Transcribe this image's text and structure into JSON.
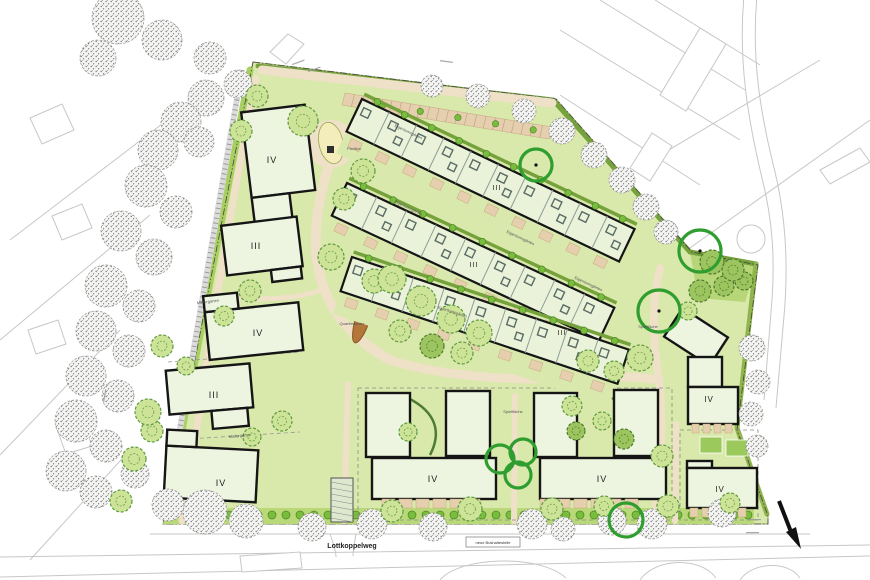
{
  "plan": {
    "street_name": "Lottkoppelweg",
    "bus_stop_label": "neue Bushaltestelle",
    "square_label": "Quartiersplatz",
    "pavilion_label": "Pavillon",
    "play_label": "Spielfläche",
    "owner_garden_label": "Eigentumsgärten",
    "tenant_garden_label": "Mietergärten"
  },
  "colors": {
    "lawn": "#d9e8ab",
    "lawn2": "#cfe39c",
    "rowfill": "#eaf3da",
    "bldg": "#edf5e1",
    "tan": "#efe0c8",
    "tandark": "#e5cfae",
    "hedge": "#76a23c",
    "hedge2": "#a9cf63",
    "bush": "#79bd3c",
    "bushline": "#4c8428",
    "tree": "#cde397",
    "treeline": "#5d9a3d",
    "dtree": "#9cc45f",
    "dtreeline": "#4d7a2e",
    "yellow": "#f3edbb",
    "ring": "#2f9e2f",
    "ctx": "#c7c7c7",
    "stip": "#777777",
    "black": "#151515",
    "court": "#9bc95c",
    "leaf": "#b5763a",
    "leafline": "#8a5526"
  },
  "site_outline": "253,62 556,99 692,252 758,265 737,430 768,516 768,524 163,524",
  "hedges": [
    {
      "d": "M 258,66 L 553,100",
      "w": 5,
      "c": "#76a23c"
    },
    {
      "d": "M 553,100 L 690,252 L 756,264",
      "w": 5,
      "c": "#76a23c"
    },
    {
      "d": "M 756,264 L 737,428 L 767,514",
      "w": 5,
      "c": "#8fb54c"
    },
    {
      "d": "M 250,70 L 166,515",
      "w": 7,
      "c": "#a9cf63"
    }
  ],
  "ne_wedge": "690,252 757,265 745,302 698,298",
  "bottom_band": {
    "x1": 168,
    "x2": 754,
    "ytop": 508,
    "ybot": 524,
    "bushy": 515,
    "step": 14
  },
  "roads": [
    {
      "d": "M 262,70 L 552,103",
      "w": 9
    },
    {
      "d": "M 331,160 C 315,205 311,248 322,283 C 333,317 359,344 392,361",
      "w": 10
    },
    {
      "d": "M 392,361 C 448,377 517,381 560,378 C 608,375 640,377 659,380",
      "w": 9
    },
    {
      "d": "M 659,380 C 652,338 652,300 660,268",
      "w": 8
    },
    {
      "d": "M 659,380 C 664,428 661,470 656,506",
      "w": 8
    },
    {
      "d": "M 348,384 L 344,521",
      "w": 6
    },
    {
      "d": "M 515,396 L 514,521",
      "w": 6
    },
    {
      "d": "M 676,424 L 675,521",
      "w": 6
    },
    {
      "d": "M 256,78 C 236,180 216,300 201,400 C 193,455 186,492 182,521",
      "w": 7
    },
    {
      "d": "M 232,297 C 260,300 290,300 318,291",
      "w": 5
    }
  ],
  "ladder_path": {
    "d": "M 242,70 L 165,515"
  },
  "parking": {
    "poly": "345,93 552,127 549,139 342,105",
    "n": 22
  },
  "plaza": {
    "cx": 331,
    "cy": 144,
    "r": 24,
    "ell": [
      331,
      143,
      12,
      21,
      -12
    ],
    "pav": [
      327,
      146,
      7,
      7
    ]
  },
  "ovals": [
    {
      "e": [
        412,
        317,
        30,
        18,
        20
      ],
      "f": "#f3edbb"
    },
    {
      "e": [
        444,
        336,
        22,
        12,
        15
      ],
      "f": "#f3edbb"
    },
    {
      "e": [
        268,
        330,
        26,
        13,
        -18
      ],
      "f": "#f0ecc0"
    },
    {
      "e": [
        268,
        330,
        30,
        16,
        -18
      ],
      "f": "none",
      "s": "#6f9c3c"
    },
    {
      "e": [
        402,
        428,
        12,
        9,
        0
      ],
      "f": "#f2ebb7"
    }
  ],
  "swing_circle": [
    416,
    315,
    9
  ],
  "leaf": [
    363,
    318,
    7,
    26,
    18
  ],
  "rows": [
    {
      "x": 362,
      "y": 99,
      "rot": 25.5,
      "len": 302,
      "units": 10
    },
    {
      "x": 347,
      "y": 183,
      "rot": 25,
      "len": 295,
      "units": 9
    },
    {
      "x": 352,
      "y": 257,
      "rot": 18.5,
      "len": 292,
      "units": 9
    }
  ],
  "buildings": [
    {
      "cx": 281,
      "cy": 166,
      "rot": -7,
      "parts": [
        [
          -33,
          -58,
          64,
          86
        ],
        [
          -33,
          28,
          38,
          34
        ]
      ]
    },
    {
      "cx": 262,
      "cy": 247,
      "rot": -7,
      "parts": [
        [
          -38,
          -26,
          76,
          50
        ],
        [
          6,
          24,
          30,
          12
        ]
      ]
    },
    {
      "cx": 255,
      "cy": 331,
      "rot": -6,
      "parts": [
        [
          -48,
          -24,
          94,
          48
        ],
        [
          -48,
          -40,
          34,
          16
        ]
      ]
    },
    {
      "cx": 210,
      "cy": 395,
      "rot": -5,
      "parts": [
        [
          -42,
          -28,
          84,
          44
        ],
        [
          0,
          16,
          36,
          18
        ]
      ]
    },
    {
      "cx": 212,
      "cy": 474,
      "rot": 3,
      "parts": [
        [
          -47,
          -26,
          92,
          52
        ],
        [
          -47,
          -42,
          30,
          16
        ]
      ]
    },
    {
      "cx": 388,
      "cy": 425,
      "rot": 0,
      "parts": [
        [
          -22,
          -32,
          44,
          64
        ]
      ]
    },
    {
      "cx": 468,
      "cy": 423,
      "rot": 0,
      "parts": [
        [
          -22,
          -32,
          44,
          65
        ]
      ]
    },
    {
      "cx": 434,
      "cy": 478,
      "rot": 0,
      "parts": [
        [
          -62,
          -20,
          124,
          41
        ]
      ]
    },
    {
      "cx": 555,
      "cy": 425,
      "rot": 0,
      "parts": [
        [
          -21,
          -32,
          43,
          64
        ]
      ]
    },
    {
      "cx": 636,
      "cy": 423,
      "rot": 0,
      "parts": [
        [
          -22,
          -33,
          44,
          66
        ]
      ]
    },
    {
      "cx": 603,
      "cy": 478,
      "rot": 0,
      "parts": [
        [
          -63,
          -20,
          126,
          41
        ]
      ]
    },
    {
      "cx": 696,
      "cy": 337,
      "rot": 33,
      "parts": [
        [
          -27,
          -17,
          54,
          34
        ]
      ]
    },
    {
      "cx": 713,
      "cy": 390,
      "rot": 0,
      "parts": [
        [
          -25,
          -33,
          34,
          30
        ],
        [
          -25,
          -3,
          50,
          37
        ]
      ]
    },
    {
      "cx": 722,
      "cy": 488,
      "rot": 0,
      "parts": [
        [
          -35,
          -27,
          25,
          7
        ],
        [
          -35,
          -20,
          70,
          40
        ]
      ]
    }
  ],
  "terrace_rows": [
    [
      382,
      499,
      6,
      17
    ],
    [
      540,
      499,
      6,
      17
    ],
    [
      692,
      424,
      4,
      11
    ],
    [
      690,
      508,
      5,
      12
    ]
  ],
  "arcs": [
    "M 408,398 C 436,412 442,432 430,455",
    "M 612,398 C 640,412 646,432 634,455"
  ],
  "courts": [
    [
      700,
      437,
      22,
      16
    ],
    [
      726,
      440,
      22,
      16
    ]
  ],
  "carport": [
    331,
    478,
    22,
    44
  ],
  "dash_shapes": [
    {
      "t": "rect",
      "v": [
        358,
        388,
        314,
        132
      ]
    },
    {
      "t": "rect",
      "v": [
        680,
        430,
        78,
        90
      ]
    },
    {
      "t": "line",
      "v": [
        168,
        362,
        300,
        352
      ]
    },
    {
      "t": "line",
      "v": [
        172,
        440,
        300,
        432
      ]
    }
  ],
  "rings": [
    [
      536,
      165,
      16,
      1
    ],
    [
      700,
      251,
      21,
      1
    ],
    [
      659,
      311,
      21,
      1
    ],
    [
      500,
      459,
      14,
      0
    ],
    [
      523,
      452,
      13,
      0
    ],
    [
      518,
      475,
      13,
      0
    ],
    [
      626,
      520,
      17,
      0
    ]
  ],
  "trees_green": [
    [
      303,
      121,
      15,
      0
    ],
    [
      363,
      171,
      12,
      0
    ],
    [
      344,
      199,
      11,
      0
    ],
    [
      331,
      257,
      13,
      0
    ],
    [
      374,
      281,
      12,
      0
    ],
    [
      392,
      279,
      14,
      0
    ],
    [
      421,
      301,
      15,
      0
    ],
    [
      451,
      319,
      14,
      0
    ],
    [
      479,
      333,
      13,
      0
    ],
    [
      400,
      331,
      11,
      0
    ],
    [
      432,
      346,
      12,
      1
    ],
    [
      462,
      353,
      11,
      0
    ],
    [
      250,
      291,
      11,
      0
    ],
    [
      224,
      316,
      10,
      0
    ],
    [
      162,
      346,
      11,
      0
    ],
    [
      186,
      366,
      9,
      0
    ],
    [
      152,
      431,
      11,
      0
    ],
    [
      282,
      421,
      10,
      0
    ],
    [
      252,
      437,
      9,
      0
    ],
    [
      148,
      412,
      13,
      0
    ],
    [
      134,
      459,
      12,
      0
    ],
    [
      121,
      501,
      11,
      0
    ],
    [
      257,
      96,
      11,
      0
    ],
    [
      241,
      131,
      11,
      0
    ],
    [
      588,
      361,
      11,
      0
    ],
    [
      614,
      371,
      10,
      0
    ],
    [
      640,
      358,
      13,
      0
    ],
    [
      700,
      291,
      11,
      1
    ],
    [
      724,
      286,
      10,
      1
    ],
    [
      744,
      281,
      9,
      1
    ],
    [
      688,
      311,
      9,
      0
    ],
    [
      572,
      406,
      10,
      0
    ],
    [
      602,
      421,
      9,
      0
    ],
    [
      662,
      456,
      11,
      0
    ],
    [
      392,
      511,
      11,
      0
    ],
    [
      470,
      509,
      12,
      0
    ],
    [
      552,
      509,
      11,
      0
    ],
    [
      604,
      506,
      10,
      0
    ],
    [
      668,
      506,
      11,
      0
    ],
    [
      730,
      503,
      10,
      0
    ],
    [
      408,
      432,
      9,
      0
    ],
    [
      576,
      431,
      9,
      1
    ],
    [
      624,
      439,
      10,
      1
    ],
    [
      712,
      262,
      12,
      1
    ],
    [
      733,
      270,
      11,
      1
    ]
  ],
  "trees_gray": [
    [
      118,
      18,
      26
    ],
    [
      162,
      40,
      20
    ],
    [
      98,
      58,
      18
    ],
    [
      210,
      58,
      16
    ],
    [
      238,
      84,
      14
    ],
    [
      206,
      98,
      18
    ],
    [
      181,
      122,
      20
    ],
    [
      158,
      150,
      20
    ],
    [
      199,
      142,
      15
    ],
    [
      146,
      186,
      21
    ],
    [
      176,
      212,
      16
    ],
    [
      121,
      231,
      20
    ],
    [
      154,
      257,
      18
    ],
    [
      106,
      286,
      21
    ],
    [
      139,
      306,
      16
    ],
    [
      96,
      331,
      20
    ],
    [
      129,
      351,
      16
    ],
    [
      86,
      376,
      20
    ],
    [
      118,
      396,
      16
    ],
    [
      76,
      421,
      21
    ],
    [
      106,
      446,
      16
    ],
    [
      66,
      471,
      20
    ],
    [
      96,
      492,
      16
    ],
    [
      135,
      474,
      14
    ],
    [
      432,
      86,
      11
    ],
    [
      478,
      96,
      12
    ],
    [
      524,
      111,
      12
    ],
    [
      562,
      131,
      13
    ],
    [
      594,
      155,
      13
    ],
    [
      622,
      180,
      13
    ],
    [
      646,
      207,
      13
    ],
    [
      666,
      232,
      12
    ],
    [
      205,
      512,
      22
    ],
    [
      246,
      521,
      17
    ],
    [
      312,
      527,
      14
    ],
    [
      372,
      524,
      15
    ],
    [
      433,
      527,
      14
    ],
    [
      532,
      524,
      15
    ],
    [
      563,
      529,
      12
    ],
    [
      612,
      521,
      14
    ],
    [
      652,
      524,
      15
    ],
    [
      722,
      513,
      14
    ],
    [
      168,
      505,
      16
    ],
    [
      752,
      348,
      13
    ],
    [
      758,
      382,
      12
    ],
    [
      751,
      414,
      12
    ],
    [
      757,
      446,
      11
    ]
  ],
  "numerals": [
    {
      "t": "IV",
      "x": 272,
      "y": 163,
      "s": 9
    },
    {
      "t": "III",
      "x": 256,
      "y": 249,
      "s": 9
    },
    {
      "t": "IV",
      "x": 258,
      "y": 336,
      "s": 9
    },
    {
      "t": "III",
      "x": 214,
      "y": 398,
      "s": 9
    },
    {
      "t": "IV",
      "x": 221,
      "y": 486,
      "s": 9
    },
    {
      "t": "III",
      "x": 497,
      "y": 190,
      "s": 7
    },
    {
      "t": "III",
      "x": 474,
      "y": 267,
      "s": 7
    },
    {
      "t": "III",
      "x": 562,
      "y": 335,
      "s": 7
    },
    {
      "t": "IV",
      "x": 433,
      "y": 482,
      "s": 9
    },
    {
      "t": "IV",
      "x": 602,
      "y": 482,
      "s": 9
    },
    {
      "t": "IV",
      "x": 709,
      "y": 402,
      "s": 8
    },
    {
      "t": "IV",
      "x": 720,
      "y": 492,
      "s": 8
    }
  ],
  "small_labels": [
    {
      "k": "square_label",
      "x": 352,
      "y": 325,
      "r": 0
    },
    {
      "k": "play_label",
      "x": 648,
      "y": 328,
      "r": 0
    },
    {
      "k": "play_label",
      "x": 513,
      "y": 413,
      "r": 0
    },
    {
      "k": "pavilion_label",
      "x": 354,
      "y": 150,
      "r": 0
    },
    {
      "k": "owner_garden_label",
      "x": 408,
      "y": 209,
      "r": 25
    },
    {
      "k": "owner_garden_label",
      "x": 520,
      "y": 239,
      "r": 25
    },
    {
      "k": "owner_garden_label",
      "x": 452,
      "y": 313,
      "r": 18
    },
    {
      "k": "owner_garden_label",
      "x": 588,
      "y": 285,
      "r": 25
    },
    {
      "k": "owner_garden_label",
      "x": 408,
      "y": 133,
      "r": 25
    },
    {
      "k": "tenant_garden_label",
      "x": 208,
      "y": 303,
      "r": -7
    },
    {
      "k": "tenant_garden_label",
      "x": 240,
      "y": 437,
      "r": -5
    }
  ],
  "micro_notes": [
    [
      292,
      64,
      -20
    ],
    [
      308,
      71,
      -20
    ],
    [
      748,
      519,
      0
    ],
    [
      746,
      532,
      0
    ],
    [
      103,
      402,
      -80
    ],
    [
      440,
      60,
      8
    ]
  ],
  "street": {
    "x": 352,
    "y": 548
  },
  "bus_box": [
    466,
    537,
    54,
    10
  ],
  "arrow": {
    "line": [
      779,
      501,
      793,
      537
    ],
    "head": "786,532 801,549 796,527"
  },
  "context": {
    "lines": [
      "M 744,-4 C 738,60 748,120 762,178 C 772,218 776,258 771,312 L 764,400",
      "M 757,-4 C 751,60 761,116 775,172 C 785,214 789,260 784,316 L 776,408",
      "M 150,534 L 810,534",
      "M 0,557 C 250,552 560,547 870,545",
      "M 0,577 C 250,571 560,561 870,556",
      "M 330,534 C 334,545 336,552 336,557",
      "M 356,534 C 354,545 353,551 353,556",
      "M 10,240 L 200,95",
      "M 0,340 L 150,215",
      "M 0,455 L 120,330",
      "M 30,560 L 130,450",
      "M 560,30 L 740,140",
      "M 560,95 L 700,185",
      "M 600,0 L 745,90",
      "M 655,0 L 760,65",
      "M 610,185 L 820,60",
      "M 680,255 L 870,120",
      "M 440,580 C 460,556 540,554 566,578",
      "M 640,580 C 655,558 700,556 716,578",
      "M 740,580 C 752,562 788,560 800,578"
    ],
    "houses": [
      "660,95 700,28 726,44 686,111",
      "630,168 652,133 672,146 650,181",
      "270,52 288,34 304,44 286,64",
      "30,118 62,104 74,130 42,144",
      "52,216 82,204 92,228 62,240",
      "28,330 58,320 66,344 36,354",
      "58,432 84,424 92,446 66,454",
      "240,556 300,552 302,568 242,572",
      "820,170 860,148 870,162 830,184"
    ],
    "circle": [
      751,
      239,
      14
    ]
  }
}
